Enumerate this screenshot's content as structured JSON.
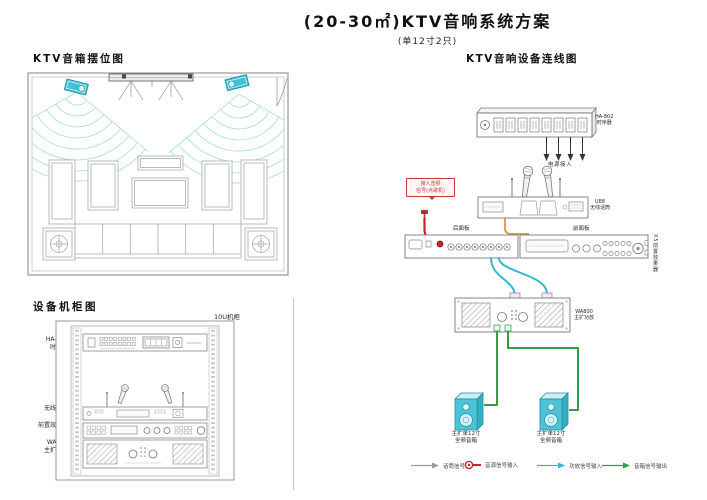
{
  "header": {
    "title": "(20-30㎡)KTV音响系统方案",
    "subtitle": "(单12寸2只)"
  },
  "placement": {
    "title": "KTV音箱摆位图"
  },
  "cabinet": {
    "title": "设备机柜图",
    "rack_size": "10U机柜",
    "devices": [
      {
        "model": "HA-802",
        "name": "时序器"
      },
      {
        "model": "U88",
        "name": "无线话筒"
      },
      {
        "model": "X5",
        "name": "前置效果器"
      },
      {
        "model": "WA800",
        "name": "主扩功放"
      }
    ]
  },
  "wiring": {
    "title": "KTV音响设备连线图",
    "power_label": "电源接入",
    "sequencer": {
      "model": "HA-802",
      "name": "时序器"
    },
    "receiver": {
      "model": "U88",
      "name": "无线话筒"
    },
    "source_note": {
      "line1": "接入音频",
      "line2": "信号(点歌机)"
    },
    "rear_panel_label": "后面板",
    "front_panel_label": "前面板",
    "fx_side_label": "X5前置效果器",
    "amp": {
      "model": "WA800",
      "name": "主扩功放"
    },
    "speaker_label": {
      "line1": "主扩单12寸",
      "line2": "全频音箱"
    }
  },
  "legend": [
    {
      "label": "话筒信号",
      "color": "#9b9b9b"
    },
    {
      "label": "音源信号输入",
      "color": "#c0262c"
    },
    {
      "label": "功放信号输入",
      "color": "#35b6cc"
    },
    {
      "label": "音箱信号输出",
      "color": "#2f9e49"
    }
  ],
  "colors": {
    "speaker_cyan": "#4cc3d6",
    "cable_red": "#c0262c",
    "cable_orange": "#e0a040",
    "cable_cyan": "#35b6cc",
    "cable_green": "#2f9e49"
  }
}
